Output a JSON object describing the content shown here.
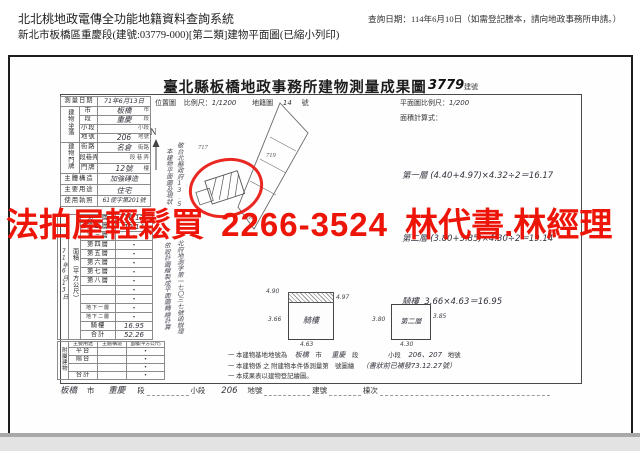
{
  "app": {
    "system_title": "北北桃地政電傳全功能地籍資料查詢系統",
    "query_date": "查詢日期：114年6月10日（如需登記謄本，請向地政事務所申請。）",
    "doc_line": "新北市板橋區重慶段(建號:03779-000)[第二類]建物平面圖(已縮小列印)"
  },
  "watermark": {
    "text_left": "法拍屋輕鬆買",
    "phone": "2266-3524",
    "text_right": "林代書.林經理",
    "color": "#ed1408"
  },
  "form": {
    "title": "臺北縣板橋地政事務所建物測量成果圖",
    "building_no": "3779",
    "building_no_unit": "建號",
    "survey_date_label": "測量日期",
    "survey_date_value": "71年6月13日",
    "location_map_label": "位置圖",
    "location_scale_label": "比例尺：",
    "location_scale_value": "1/1200",
    "cadastral_label": "地籍圖",
    "cadastral_value": "14",
    "cadastral_unit": "號",
    "plan_scale_label": "平面圖比例尺：",
    "plan_scale_value": "1/200",
    "north_label": "N",
    "formula_title": "面積計算式：",
    "formula_1": "第一層 (4.40+4.97)×4.32÷2＝16.17",
    "formula_2": "第二層 (3.80+3.85)×4.30÷2＝19.14",
    "formula_3": "騎樓  3.66×4.63＝16.95",
    "site_group": "建物坐落",
    "site_rows": [
      {
        "label": "市",
        "value": "板橋",
        "unit": "市"
      },
      {
        "label": "段",
        "value": "重慶",
        "unit": "段"
      },
      {
        "label": "小段",
        "value": "",
        "unit": "小段"
      },
      {
        "label": "地號",
        "value": "206",
        "unit": "地號"
      }
    ],
    "door_group": "建物門牌",
    "door_rows": [
      {
        "label": "街路",
        "value": "名倉",
        "unit": "街路"
      },
      {
        "label": "段巷弄",
        "value": "",
        "unit": "段 巷 弄"
      },
      {
        "label": "門牌",
        "value": "12號",
        "unit": "樓"
      }
    ],
    "structure_label": "主體構造",
    "structure_value": "加強磚造",
    "use_label": "主要用途",
    "use_value": "住宅",
    "license_label": "使用執照",
    "license_value": "61使字第201號",
    "area": {
      "vertical_label": "面積（平方公尺）",
      "date_vertical": "71年6月13日",
      "rows": [
        {
          "label": "第一層",
          "value": "16.17"
        },
        {
          "label": "第二層",
          "value": "19.14"
        },
        {
          "label": "第三層",
          "value": "・"
        },
        {
          "label": "第四層",
          "value": "・"
        },
        {
          "label": "第五層",
          "value": "・"
        },
        {
          "label": "第六層",
          "value": "・"
        },
        {
          "label": "第七層",
          "value": "・"
        },
        {
          "label": "第八層",
          "value": "・"
        },
        {
          "label": "",
          "value": "・"
        },
        {
          "label": "",
          "value": "・"
        },
        {
          "label": "地下一層",
          "value": "・"
        },
        {
          "label": "地下二層",
          "value": "・"
        },
        {
          "label": "騎樓",
          "value": "16.95"
        },
        {
          "label": "合計",
          "value": "52.26"
        }
      ]
    },
    "annex": {
      "vertical_label": "附屬建物",
      "headers": [
        "主要用途",
        "主體構造",
        "面積(平方公尺)"
      ],
      "rows": [
        {
          "use": "平台",
          "area": "・"
        },
        {
          "use": "陽台",
          "area": "・"
        },
        {
          "use": "",
          "area": "・"
        },
        {
          "use": "合計",
          "area": "・"
        }
      ]
    },
    "vertical_notes": {
      "n1": "本建物平面圖及現狀",
      "n2": "敬台北縣政府13.5",
      "n3": "依設計圖繪製成平面圖轉繪計算",
      "n4": "北府地測字第一七〇三七號函辦理"
    },
    "sketch": {
      "p1": "717",
      "p2": "719",
      "p3": "206"
    },
    "plans": {
      "qilou": {
        "label": "騎樓",
        "top": "4.90",
        "right": "4.97",
        "left": "3.66",
        "bottom": "4.63"
      },
      "second": {
        "label": "第二層",
        "left": "3.80",
        "right": "3.85",
        "bottom": "4.30"
      }
    },
    "notes": {
      "line1_pre": "一 本建物基地地號為",
      "line1_city": "板橋",
      "line1_city_u": "市",
      "line1_sec": "重慶",
      "line1_sec_u": "段",
      "line1_sub_u": "小段",
      "line1_parcel": "206、207",
      "line1_parcel_u": "地號",
      "line2": "一 本建物係 之 附建物本件係測量第　號圖繪",
      "line2_hw": "（書狀前已補發73.12.27號）",
      "line3": "一 本成果表以建物登記繪圖。"
    },
    "footer": {
      "city": "板橋",
      "city_u": "市",
      "sec": "重慶",
      "sec_u": "段",
      "sub_u": "小段",
      "parcel": "206",
      "parcel_u": "地號",
      "bno_u": "建號",
      "unit_u": "棟次"
    }
  }
}
